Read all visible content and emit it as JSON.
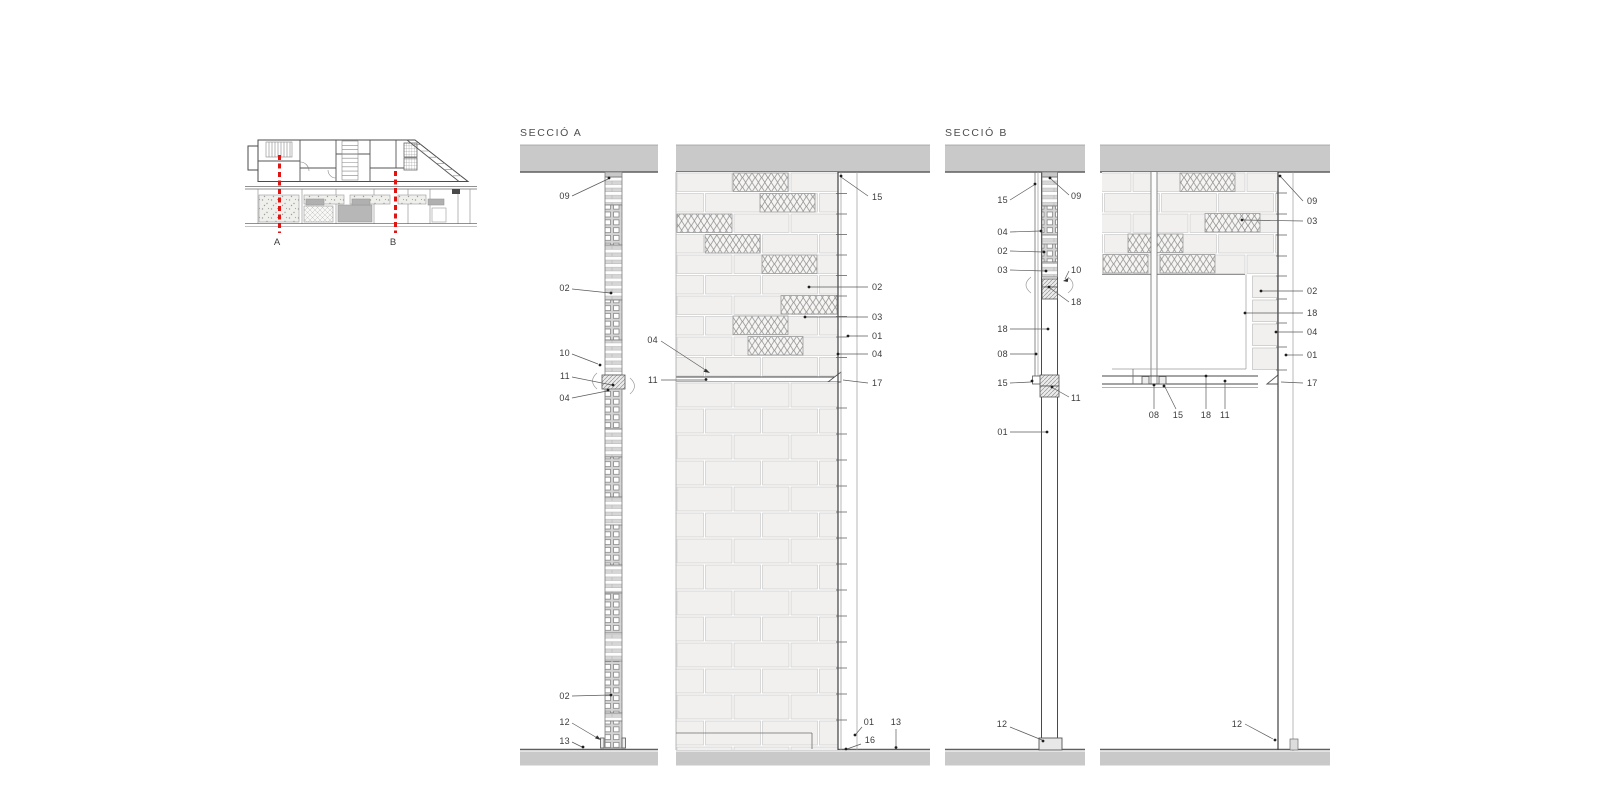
{
  "titles": {
    "section_a": "SECCIÓ A",
    "section_b": "SECCIÓ B"
  },
  "plan": {
    "mark_a": "A",
    "mark_b": "B"
  },
  "callouts": {
    "d1": {
      "c09": "09",
      "c02a": "02",
      "c10": "10",
      "c11": "11",
      "c04": "04",
      "c02b": "02",
      "c12": "12",
      "c13": "13"
    },
    "d2": {
      "c15": "15",
      "c02": "02",
      "c03": "03",
      "c01": "01",
      "c04r": "04",
      "c17": "17",
      "c04l": "04",
      "c11": "11",
      "c01b": "01",
      "c13": "13",
      "c16": "16"
    },
    "d3": {
      "c15a": "15",
      "c09": "09",
      "c04": "04",
      "c02": "02",
      "c03": "03",
      "c10": "10",
      "c18a": "18",
      "c18b": "18",
      "c08": "08",
      "c15b": "15",
      "c11": "11",
      "c01": "01",
      "c12": "12"
    },
    "d4": {
      "c09": "09",
      "c03": "03",
      "c02": "02",
      "c18a": "18",
      "c04": "04",
      "c01": "01",
      "c17": "17",
      "c08": "08",
      "c15": "15",
      "c18b": "18",
      "c11": "11",
      "c12": "12"
    }
  },
  "colors": {
    "slab": "#c9c9c9",
    "line": "#4a4a4a",
    "brick": "#f1f0ee",
    "brickline": "#cccccc",
    "lattice": "#8d8d8d",
    "hatch": "#949494",
    "red": "#e11414",
    "label": "#3c3c3c",
    "leader": "#5a5a5a"
  }
}
